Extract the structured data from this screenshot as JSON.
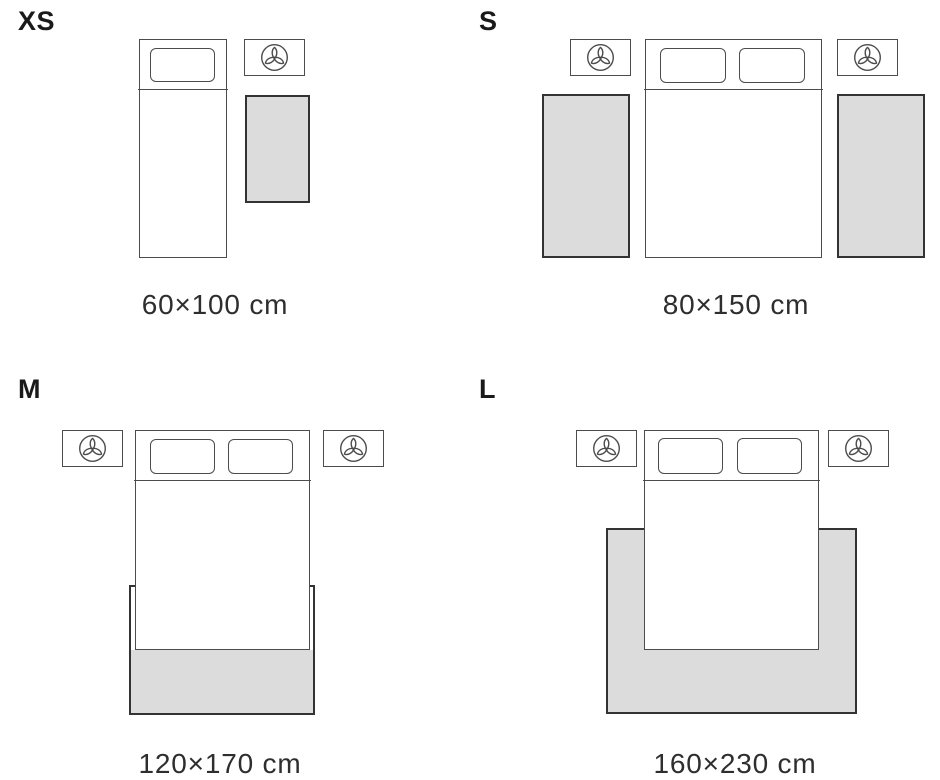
{
  "colors": {
    "stroke": "#4c4c4c",
    "rug_stroke": "#333333",
    "rug_fill": "#dcdcdc",
    "text": "#2e2e2e",
    "label": "#1a1a1a"
  },
  "icons": {
    "nightstand": "lamp-trefoil-icon"
  },
  "sections": [
    {
      "label": "XS",
      "dimension": "60×100 cm",
      "rugs": 1,
      "bed": "single",
      "nightstands": 1
    },
    {
      "label": "S",
      "dimension": "80×150 cm",
      "rugs": 2,
      "bed": "double",
      "nightstands": 2
    },
    {
      "label": "M",
      "dimension": "120×170 cm",
      "rugs": 1,
      "bed": "double",
      "nightstands": 2
    },
    {
      "label": "L",
      "dimension": "160×230 cm",
      "rugs": 1,
      "bed": "double",
      "nightstands": 2
    }
  ]
}
